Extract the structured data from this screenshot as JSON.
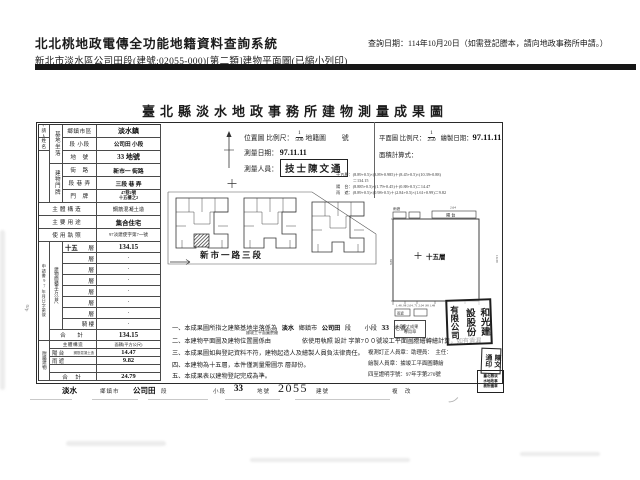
{
  "header": {
    "system_title": "北北桃地政電傳全功能地籍資料查詢系統",
    "subtitle": "新北市淡水區公司田段(建號:02055-000)[第二類]建物平面圖(已縮小列印)",
    "query_date": "查詢日期：114年10月20日（如需登記謄本，請向地政事務所申請。）"
  },
  "form": {
    "title": "臺北縣淡水地政事務所建物測量成果圖",
    "applicant": {
      "row1": "申請人",
      "row2": "姓　名"
    },
    "groups": {
      "site": "基地坐落",
      "address": "建物門牌"
    },
    "rows": {
      "r1": {
        "label": "鄉鎮市區",
        "value": "淡水鎮"
      },
      "r2": {
        "label": "段 小段",
        "value": "公司田 小段"
      },
      "r3": {
        "label": "地　號",
        "value": "33 地號"
      },
      "r4": {
        "label": "街　路",
        "value": "新市一 街路"
      },
      "r5": {
        "label": "段 巷 弄",
        "value": "三段 巷 弄"
      },
      "r6": {
        "label": "門　牌",
        "value1": "47巷2號",
        "value2": "十五樓之2"
      },
      "r7": {
        "label": "主體構造",
        "value": "鋼筋混凝土造"
      },
      "r8": {
        "label": "主要用途",
        "value": "集合住宅"
      },
      "r9": {
        "label": "使用執照",
        "value": "97淡建使字第7一號"
      }
    },
    "receipt_vertical": "申請書97年月日字第號",
    "area": {
      "side_label": "建物面積平方公尺",
      "rows": [
        {
          "num": "十五",
          "unit": "層",
          "value": "134.15"
        },
        {
          "num": "",
          "unit": "層",
          "value": "·"
        },
        {
          "num": "",
          "unit": "層",
          "value": "·"
        },
        {
          "num": "",
          "unit": "層",
          "value": "·"
        },
        {
          "num": "",
          "unit": "層",
          "value": "·"
        },
        {
          "num": "",
          "unit": "層",
          "value": "·"
        },
        {
          "num": "",
          "unit": "層",
          "value": "·"
        },
        {
          "num": "",
          "unit": "騎 樓",
          "value": "·"
        }
      ],
      "total_label": "合　計",
      "total_value": "134.15"
    },
    "annex": {
      "side_label": "附屬建物",
      "header": {
        "c1": "主體構造",
        "c2": "面積(平方公尺)"
      },
      "rows": [
        {
          "name": "陽 台",
          "struct": "鋼筋混凝土造",
          "value": "14.47"
        },
        {
          "name": "雨 遮",
          "struct": "",
          "value": "9.82"
        },
        {
          "name": "",
          "struct": "",
          "value": ""
        },
        {
          "name": "合 計",
          "struct": "",
          "value": "24.79"
        }
      ]
    },
    "loc": {
      "label": "位置圖 比例尺：",
      "num": "1",
      "den": "500",
      "suffix": "地籍圖",
      "sheet": "號",
      "survey_date_label": "測量日期：",
      "survey_date": "97.11.11",
      "surveyor_label": "測量人員：",
      "surveyor": "技士陳文通"
    },
    "plan": {
      "label": "平面圖 比例尺：",
      "num": "1",
      "den": "250",
      "draw_label": "繪製日期：",
      "draw_date": "97.11.11",
      "calc_label": "面積計算式：",
      "calc_lines": [
        "十五層：(8.89+0.5)×(3.89+0.985)＋(8.45+0.5)×(10.39+0.88)",
        "　　　　＝134.15",
        "陽　台：(8.885+0.5)×(1.79+0.45)＋(0.88+0.5)＝14.47",
        "雨　遮：(8.89+0.5)×(0.98+0.5)＋(2.84+0.5)×(1.61+0.99)＝9.82"
      ]
    },
    "siteplan": {
      "street": "新市一路三段"
    },
    "detail": {
      "floor": "十五層",
      "balcony": "陽 台",
      "canopy1": "雨遮",
      "canopy2": "雨遮",
      "dim_bottom": "1.48  .98  2.04  .71  2.04  .98  1.48",
      "dim_right": "10.39",
      "dim_left": "8.89",
      "dim_top": "2.64"
    },
    "notes": {
      "n1_parts": [
        "一、本成果圖所指之建築基地坐落係為",
        "淡水",
        "鄉鎮市",
        "公司田",
        "段",
        "小段",
        "33",
        "地號。"
      ],
      "n2": "二、本建物平面圖及建物位置圖係由　　　　　依使用執照 設計 字第7００號竣工平面圖謄繪轉繪計算，如有遺漏",
      "n2_note": "據竣工平面圖謄繪",
      "n3": "三、本成果圖如與登記資料不符，建物起造人及繪製人員負法律責任。",
      "n4": "四、本建物為十五層，本件僅測量需圖示 層部份。",
      "n5": "五、本成果表以建物登記完成為準。",
      "r1": "複測訂正人員章：助理員：　主任：",
      "r2": "繪製人員章：據竣工平面圖轉繪",
      "r3": "四至證明字號：97年字第270號"
    },
    "stamps": {
      "company_cols": [
        "和光建",
        "設股份",
        "有限公司"
      ],
      "small_rows": [
        "複丈成果",
        "專用章"
      ],
      "personal": [
        "陳文",
        "通印"
      ],
      "dense_rows": [
        "臺北縣淡",
        "水地政事",
        "務所圖章"
      ]
    },
    "footer": {
      "v1": "淡水",
      "l1": "鄉鎮市",
      "v2": "公司田",
      "l2": "段",
      "l3": "小段",
      "v3": "33",
      "l4": "地號",
      "v4": "2055",
      "l5": "建號",
      "l6": "複 改"
    },
    "margin_note": "4m",
    "pen_mark": "ノ"
  }
}
